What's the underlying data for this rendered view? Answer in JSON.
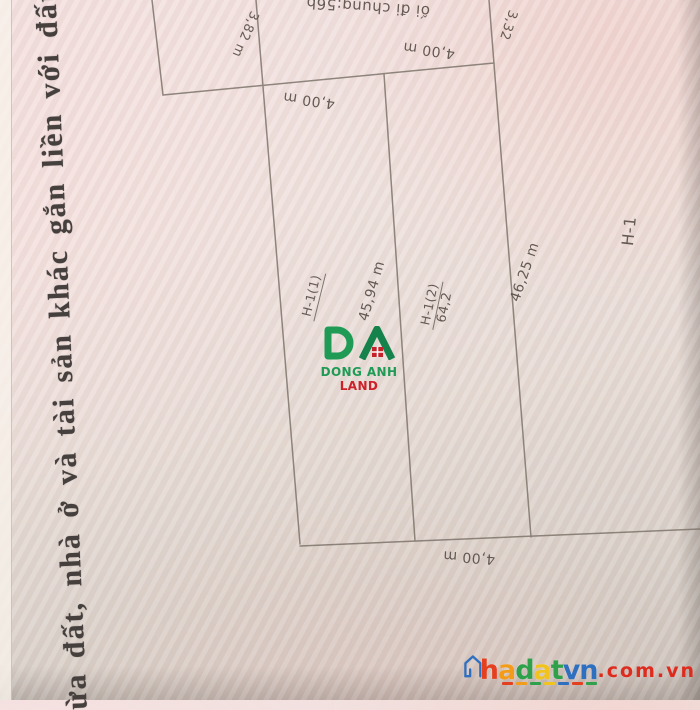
{
  "document": {
    "left_margin_text": "ừa đất, nhà ở và tài sản khác gắn liền với đất"
  },
  "drawing": {
    "top_note": "ối đi chung:56b",
    "dims": {
      "top_left_segment": "3,82 m",
      "top_right_segment": "3,32",
      "width_top": "4,00 m",
      "width_mid": "4,00 m",
      "width_bottom": "4,00 m",
      "edge_middle_length": "45,94 m",
      "edge_right_length": "46,25 m"
    },
    "parcels": {
      "p1_label": "H-1(1)",
      "p2_label": "H-1(2)",
      "p2_area": "64,2",
      "block_label": "H-1"
    },
    "line_color": "#7a7168",
    "handwriting_color": "#5a5049",
    "paper_color": "#f0e2de"
  },
  "logo": {
    "monogram": "DA",
    "name_primary": "DONG ANH",
    "name_secondary": "LAND",
    "color_green": "#1f9b56",
    "color_dark_green": "#15824b",
    "color_red": "#c4212b"
  },
  "watermark": {
    "letters": [
      "h",
      "a",
      "d",
      "a",
      "t",
      "v",
      "n"
    ],
    "letter_colors": [
      "#e4401f",
      "#f39c1a",
      "#2fa14b",
      "#f0c41c",
      "#2fa14b",
      "#2e6fc0",
      "#2e6fc0"
    ],
    "suffix": ".com.vn",
    "suffix_color": "#df2b1e",
    "icon_color": "#2e6fc0"
  }
}
